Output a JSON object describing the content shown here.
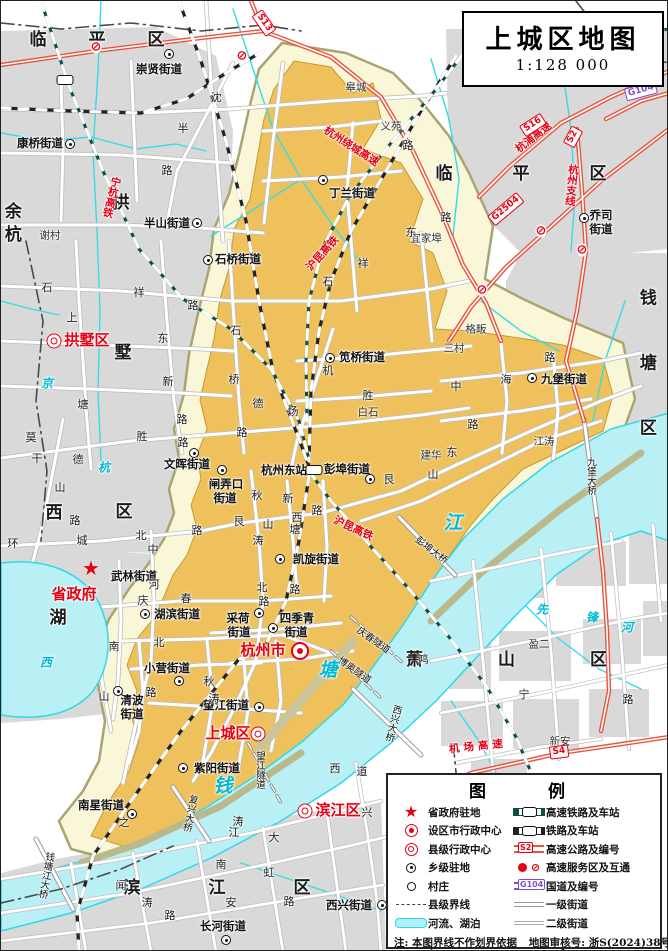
{
  "title": {
    "name": "上城区地图",
    "scale": "1:128 000"
  },
  "legend": {
    "title": "图  例",
    "left": [
      {
        "sym": "star",
        "label": "省政府驻地"
      },
      {
        "sym": "city",
        "label": "设区市行政中心"
      },
      {
        "sym": "county",
        "label": "县级行政中心"
      },
      {
        "sym": "town",
        "label": "乡级驻地"
      },
      {
        "sym": "village",
        "label": "村庄"
      },
      {
        "sym": "boundary",
        "label": "县级界线"
      },
      {
        "sym": "river",
        "label": "河流、湖泊"
      }
    ],
    "right": [
      {
        "sym": "hsr",
        "label": "高速铁路及车站"
      },
      {
        "sym": "rail",
        "label": "铁路及车站"
      },
      {
        "sym": "expwy",
        "label": "高速公路及编号",
        "badge": "S2"
      },
      {
        "sym": "service",
        "label": "高速服务区及互通"
      },
      {
        "sym": "g104",
        "label": "国道及编号",
        "badge": "G104"
      },
      {
        "sym": "road1",
        "label": "一级街道"
      },
      {
        "sym": "road2",
        "label": "二级街道"
      }
    ],
    "note": "注:  本图界线不作划界依据",
    "audit": "地图审核号:  浙S(2024)38号"
  },
  "colors": {
    "district_fill": "#eec15c",
    "district_halo": "#faf6d8",
    "water": "#b9f0f5",
    "urban": "#d9d9d9",
    "expressway": "#e8553d",
    "hsr": "#0e4d44",
    "red_label": "#e60012",
    "g_road": "#7c4fd0"
  },
  "labels": [
    {
      "t": "临平区",
      "x": 117,
      "y": 40,
      "cl": "dist",
      "ls": 42
    },
    {
      "t": "临平区",
      "x": 550,
      "y": 174,
      "cl": "dist",
      "ls": 60
    },
    {
      "t": "余杭",
      "x": 9,
      "y": 224,
      "cl": "dist",
      "v": 1,
      "ls": 6
    },
    {
      "t": "拱",
      "x": 120,
      "y": 203,
      "cl": "dist"
    },
    {
      "t": "墅",
      "x": 122,
      "y": 353,
      "cl": "dist"
    },
    {
      "t": "西",
      "x": 53,
      "y": 513,
      "cl": "dist"
    },
    {
      "t": "区",
      "x": 123,
      "y": 512,
      "cl": "dist"
    },
    {
      "t": "湖",
      "x": 57,
      "y": 618,
      "cl": "dist"
    },
    {
      "t": "钱塘区",
      "x": 644,
      "y": 385,
      "cl": "dist",
      "v": 1,
      "ls": 48
    },
    {
      "t": "萧山区",
      "x": 543,
      "y": 660,
      "cl": "dist",
      "ls": 75
    },
    {
      "t": "滨江区",
      "x": 250,
      "y": 888,
      "cl": "dist",
      "ls": 68
    },
    {
      "t": "省政府",
      "x": 73,
      "y": 594,
      "cl": "redbig",
      "n": "provincial-government"
    },
    {
      "t": "拱墅区",
      "x": 86,
      "y": 340,
      "cl": "redbig",
      "n": "gongshu-district"
    },
    {
      "t": "杭州市",
      "x": 262,
      "y": 650,
      "cl": "redbig",
      "n": "hangzhou-city"
    },
    {
      "t": "上城区",
      "x": 227,
      "y": 733,
      "cl": "redbig",
      "n": "shangcheng-district"
    },
    {
      "t": "滨江区",
      "x": 337,
      "y": 810,
      "cl": "redbig",
      "n": "binjiang-district"
    },
    {
      "t": "崇贤街道",
      "x": 158,
      "y": 68,
      "cl": "sub"
    },
    {
      "t": "康桥街道",
      "x": 39,
      "y": 142,
      "cl": "sub"
    },
    {
      "t": "半山街道",
      "x": 166,
      "y": 222,
      "cl": "sub"
    },
    {
      "t": "石桥街道",
      "x": 237,
      "y": 258,
      "cl": "sub"
    },
    {
      "t": "丁兰街道",
      "x": 351,
      "y": 192,
      "cl": "sub"
    },
    {
      "t": "乔司",
      "x": 600,
      "y": 214,
      "cl": "sub"
    },
    {
      "t": "街道",
      "x": 600,
      "y": 228,
      "cl": "sub"
    },
    {
      "t": "笕桥街道",
      "x": 361,
      "y": 356,
      "cl": "sub"
    },
    {
      "t": "文晖街道",
      "x": 186,
      "y": 463,
      "cl": "sub"
    },
    {
      "t": "闸弄口",
      "x": 225,
      "y": 483,
      "cl": "sub"
    },
    {
      "t": "街道",
      "x": 224,
      "y": 497,
      "cl": "sub"
    },
    {
      "t": "杭州东站",
      "x": 283,
      "y": 469,
      "cl": "sub",
      "n": "hangzhou-east-station"
    },
    {
      "t": "彭埠街道",
      "x": 346,
      "y": 468,
      "cl": "sub"
    },
    {
      "t": "九堡街道",
      "x": 563,
      "y": 378,
      "cl": "sub"
    },
    {
      "t": "凯旋街道",
      "x": 315,
      "y": 558,
      "cl": "sub"
    },
    {
      "t": "采荷",
      "x": 237,
      "y": 617,
      "cl": "sub"
    },
    {
      "t": "街道",
      "x": 238,
      "y": 631,
      "cl": "sub"
    },
    {
      "t": "四季青",
      "x": 296,
      "y": 617,
      "cl": "sub"
    },
    {
      "t": "街道",
      "x": 295,
      "y": 631,
      "cl": "sub"
    },
    {
      "t": "湖滨街道",
      "x": 176,
      "y": 613,
      "cl": "sub"
    },
    {
      "t": "武林街道",
      "x": 133,
      "y": 575,
      "cl": "sub"
    },
    {
      "t": "小营街道",
      "x": 166,
      "y": 667,
      "cl": "sub"
    },
    {
      "t": "清波",
      "x": 131,
      "y": 699,
      "cl": "sub"
    },
    {
      "t": "街道",
      "x": 131,
      "y": 713,
      "cl": "sub"
    },
    {
      "t": "望江街道",
      "x": 225,
      "y": 704,
      "cl": "sub"
    },
    {
      "t": "紫阳街道",
      "x": 216,
      "y": 767,
      "cl": "sub"
    },
    {
      "t": "南星街道",
      "x": 100,
      "y": 804,
      "cl": "sub"
    },
    {
      "t": "西兴街道",
      "x": 348,
      "y": 904,
      "cl": "sub"
    },
    {
      "t": "长河街道",
      "x": 222,
      "y": 925,
      "cl": "sub"
    },
    {
      "t": "谢村",
      "x": 49,
      "y": 235,
      "cl": "vil"
    },
    {
      "t": "皋城",
      "x": 355,
      "y": 87,
      "cl": "vil"
    },
    {
      "t": "义苑",
      "x": 390,
      "y": 126,
      "cl": "vil"
    },
    {
      "t": "宜家埠",
      "x": 425,
      "y": 238,
      "cl": "vil"
    },
    {
      "t": "格畈",
      "x": 475,
      "y": 329,
      "cl": "vil"
    },
    {
      "t": "三村",
      "x": 453,
      "y": 348,
      "cl": "vil"
    },
    {
      "t": "白石",
      "x": 367,
      "y": 412,
      "cl": "vil"
    },
    {
      "t": "建华",
      "x": 430,
      "y": 455,
      "cl": "vil"
    },
    {
      "t": "江涛",
      "x": 543,
      "y": 441,
      "cl": "vil"
    },
    {
      "t": "盈二",
      "x": 538,
      "y": 644,
      "cl": "vil"
    },
    {
      "t": "新安",
      "x": 559,
      "y": 741,
      "cl": "vil"
    },
    {
      "t": "沈",
      "x": 215,
      "y": 97,
      "cl": "road"
    },
    {
      "t": "半",
      "x": 182,
      "y": 128,
      "cl": "road"
    },
    {
      "t": "路",
      "x": 166,
      "y": 170,
      "cl": "road"
    },
    {
      "t": "石",
      "x": 46,
      "y": 287,
      "cl": "road"
    },
    {
      "t": "祥",
      "x": 138,
      "y": 292,
      "cl": "road"
    },
    {
      "t": "路",
      "x": 192,
      "y": 305,
      "cl": "road"
    },
    {
      "t": "石",
      "x": 327,
      "y": 281,
      "cl": "road"
    },
    {
      "t": "祥",
      "x": 362,
      "y": 263,
      "cl": "road"
    },
    {
      "t": "上",
      "x": 71,
      "y": 317,
      "cl": "road"
    },
    {
      "t": "塘",
      "x": 82,
      "y": 404,
      "cl": "road"
    },
    {
      "t": "东",
      "x": 162,
      "y": 338,
      "cl": "road"
    },
    {
      "t": "新",
      "x": 167,
      "y": 381,
      "cl": "road"
    },
    {
      "t": "路",
      "x": 181,
      "y": 419,
      "cl": "road"
    },
    {
      "t": "莫",
      "x": 30,
      "y": 437,
      "cl": "road"
    },
    {
      "t": "干",
      "x": 36,
      "y": 458,
      "cl": "road"
    },
    {
      "t": "山",
      "x": 59,
      "y": 487,
      "cl": "road"
    },
    {
      "t": "路",
      "x": 74,
      "y": 520,
      "cl": "road"
    },
    {
      "t": "德",
      "x": 77,
      "y": 459,
      "cl": "road"
    },
    {
      "t": "胜",
      "x": 141,
      "y": 436,
      "cl": "road"
    },
    {
      "t": "路",
      "x": 182,
      "y": 442,
      "cl": "road"
    },
    {
      "t": "德",
      "x": 257,
      "y": 403,
      "cl": "road"
    },
    {
      "t": "胜",
      "x": 367,
      "y": 395,
      "cl": "road"
    },
    {
      "t": "石",
      "x": 235,
      "y": 330,
      "cl": "road"
    },
    {
      "t": "桥",
      "x": 233,
      "y": 379,
      "cl": "road"
    },
    {
      "t": "路",
      "x": 241,
      "y": 432,
      "cl": "road"
    },
    {
      "t": "机",
      "x": 327,
      "y": 370,
      "cl": "road"
    },
    {
      "t": "场",
      "x": 292,
      "y": 411,
      "cl": "road"
    },
    {
      "t": "环",
      "x": 12,
      "y": 543,
      "cl": "road"
    },
    {
      "t": "城",
      "x": 81,
      "y": 540,
      "cl": "road"
    },
    {
      "t": "北",
      "x": 140,
      "y": 535,
      "cl": "road"
    },
    {
      "t": "路",
      "x": 196,
      "y": 530,
      "cl": "road"
    },
    {
      "t": "中",
      "x": 152,
      "y": 549,
      "cl": "road"
    },
    {
      "t": "河",
      "x": 153,
      "y": 584,
      "cl": "road"
    },
    {
      "t": "庆",
      "x": 142,
      "y": 600,
      "cl": "road"
    },
    {
      "t": "春",
      "x": 185,
      "y": 598,
      "cl": "road"
    },
    {
      "t": "路",
      "x": 263,
      "y": 601,
      "cl": "road"
    },
    {
      "t": "秋",
      "x": 256,
      "y": 495,
      "cl": "road"
    },
    {
      "t": "涛",
      "x": 257,
      "y": 540,
      "cl": "road"
    },
    {
      "t": "新",
      "x": 287,
      "y": 498,
      "cl": "road"
    },
    {
      "t": "塘",
      "x": 294,
      "y": 529,
      "cl": "road"
    },
    {
      "t": "艮",
      "x": 238,
      "y": 521,
      "cl": "road"
    },
    {
      "t": "山",
      "x": 267,
      "y": 524,
      "cl": "road"
    },
    {
      "t": "西",
      "x": 296,
      "y": 517,
      "cl": "road"
    },
    {
      "t": "路",
      "x": 316,
      "y": 510,
      "cl": "road"
    },
    {
      "t": "艮",
      "x": 388,
      "y": 479,
      "cl": "road"
    },
    {
      "t": "山",
      "x": 432,
      "y": 474,
      "cl": "road"
    },
    {
      "t": "东",
      "x": 451,
      "y": 452,
      "cl": "road"
    },
    {
      "t": "路",
      "x": 472,
      "y": 424,
      "cl": "road"
    },
    {
      "t": "北",
      "x": 261,
      "y": 587,
      "cl": "road"
    },
    {
      "t": "路",
      "x": 294,
      "y": 589,
      "cl": "road"
    },
    {
      "t": "中",
      "x": 455,
      "y": 386,
      "cl": "road"
    },
    {
      "t": "海",
      "x": 505,
      "y": 379,
      "cl": "road"
    },
    {
      "t": "路",
      "x": 549,
      "y": 357,
      "cl": "road"
    },
    {
      "t": "东",
      "x": 410,
      "y": 232,
      "cl": "road"
    },
    {
      "t": "路",
      "x": 445,
      "y": 217,
      "cl": "road"
    },
    {
      "t": "路",
      "x": 407,
      "y": 145,
      "cl": "road"
    },
    {
      "t": "秋",
      "x": 208,
      "y": 681,
      "cl": "road"
    },
    {
      "t": "涛",
      "x": 213,
      "y": 698,
      "cl": "road"
    },
    {
      "t": "南",
      "x": 113,
      "y": 646,
      "cl": "road"
    },
    {
      "t": "北",
      "x": 158,
      "y": 642,
      "cl": "road"
    },
    {
      "t": "山",
      "x": 103,
      "y": 696,
      "cl": "road"
    },
    {
      "t": "路",
      "x": 150,
      "y": 692,
      "cl": "road"
    },
    {
      "t": "之",
      "x": 123,
      "y": 822,
      "cl": "road"
    },
    {
      "t": "宁",
      "x": 523,
      "y": 694,
      "cl": "road"
    },
    {
      "t": "路",
      "x": 627,
      "y": 699,
      "cl": "road"
    },
    {
      "t": "鸿",
      "x": 422,
      "y": 659,
      "cl": "road"
    },
    {
      "t": "闻",
      "x": 120,
      "y": 885,
      "cl": "road"
    },
    {
      "t": "涛",
      "x": 146,
      "y": 902,
      "cl": "road"
    },
    {
      "t": "路",
      "x": 169,
      "y": 915,
      "cl": "road"
    },
    {
      "t": "南",
      "x": 220,
      "y": 864,
      "cl": "road"
    },
    {
      "t": "江",
      "x": 233,
      "y": 832,
      "cl": "road"
    },
    {
      "t": "大",
      "x": 273,
      "y": 837,
      "cl": "road"
    },
    {
      "t": "虹",
      "x": 268,
      "y": 872,
      "cl": "road"
    },
    {
      "t": "路",
      "x": 288,
      "y": 901,
      "cl": "road"
    },
    {
      "t": "安",
      "x": 230,
      "y": 902,
      "cl": "road"
    },
    {
      "t": "涛",
      "x": 237,
      "y": 821,
      "cl": "road"
    },
    {
      "t": "兴",
      "x": 366,
      "y": 812,
      "cl": "road"
    },
    {
      "t": "西",
      "x": 334,
      "y": 768,
      "cl": "road"
    },
    {
      "t": "道",
      "x": 361,
      "y": 771,
      "cl": "road"
    },
    {
      "t": "彭埠大桥",
      "x": 430,
      "y": 550,
      "cl": "brg",
      "r": 38
    },
    {
      "t": "九堡大桥",
      "x": 589,
      "y": 475,
      "cl": "brg",
      "v": 1
    },
    {
      "t": "西兴大桥",
      "x": 391,
      "y": 722,
      "cl": "brg",
      "v": 1,
      "r": 15
    },
    {
      "t": "复兴大桥",
      "x": 188,
      "y": 812,
      "cl": "brg",
      "v": 1,
      "r": 12
    },
    {
      "t": "钱塘江大桥",
      "x": 44,
      "y": 874,
      "cl": "brg",
      "v": 1,
      "r": 10
    },
    {
      "t": "望江隧道",
      "x": 258,
      "y": 769,
      "cl": "brg",
      "v": 1
    },
    {
      "t": "庆春隧道",
      "x": 372,
      "y": 640,
      "cl": "brg",
      "r": 35
    },
    {
      "t": "博奥隧道",
      "x": 353,
      "y": 670,
      "cl": "brg",
      "r": 35
    },
    {
      "t": "钱",
      "x": 222,
      "y": 786,
      "cl": "waterlb waterbig"
    },
    {
      "t": "塘",
      "x": 327,
      "y": 670,
      "cl": "waterlb waterbig"
    },
    {
      "t": "江",
      "x": 452,
      "y": 523,
      "cl": "waterlb waterbig"
    },
    {
      "t": "京",
      "x": 46,
      "y": 383,
      "cl": "waterlb"
    },
    {
      "t": "杭",
      "x": 103,
      "y": 467,
      "cl": "waterlb"
    },
    {
      "t": "西",
      "x": 45,
      "y": 662,
      "cl": "waterlb"
    },
    {
      "t": "先",
      "x": 541,
      "y": 609,
      "cl": "waterlb"
    },
    {
      "t": "锋",
      "x": 591,
      "y": 617,
      "cl": "waterlb"
    },
    {
      "t": "河",
      "x": 626,
      "y": 627,
      "cl": "waterlb"
    },
    {
      "t": "宁杭高铁",
      "x": 110,
      "y": 196,
      "cl": "railred",
      "v": 1,
      "r": 14
    },
    {
      "t": "沪昆高铁",
      "x": 322,
      "y": 253,
      "cl": "railred",
      "r": -48
    },
    {
      "t": "沪昆高铁",
      "x": 352,
      "y": 528,
      "cl": "railred",
      "r": 25
    },
    {
      "t": "杭州绕城高速",
      "x": 350,
      "y": 146,
      "cl": "railred",
      "r": 33
    },
    {
      "t": "杭浦高速",
      "x": 533,
      "y": 137,
      "cl": "railred",
      "r": -38
    },
    {
      "t": "杭州支线",
      "x": 570,
      "y": 184,
      "cl": "railred",
      "v": 1,
      "r": 6
    },
    {
      "t": "机场高速",
      "x": 477,
      "y": 746,
      "cl": "railred",
      "r": -6,
      "ls": 4
    }
  ],
  "markers": [
    {
      "k": "star",
      "x": 90,
      "y": 567,
      "n": "provincial-government-star"
    },
    {
      "k": "city",
      "x": 299,
      "y": 650,
      "n": "city-center-marker"
    },
    {
      "k": "county",
      "x": 53,
      "y": 340
    },
    {
      "k": "county",
      "x": 257,
      "y": 733
    },
    {
      "k": "county",
      "x": 304,
      "y": 810
    },
    {
      "k": "town",
      "x": 168,
      "y": 53
    },
    {
      "k": "town",
      "x": 69,
      "y": 143
    },
    {
      "k": "town",
      "x": 196,
      "y": 222
    },
    {
      "k": "town",
      "x": 207,
      "y": 259
    },
    {
      "k": "town",
      "x": 322,
      "y": 179
    },
    {
      "k": "town",
      "x": 583,
      "y": 217
    },
    {
      "k": "town",
      "x": 329,
      "y": 357
    },
    {
      "k": "town",
      "x": 193,
      "y": 452
    },
    {
      "k": "town",
      "x": 221,
      "y": 469
    },
    {
      "k": "town",
      "x": 369,
      "y": 478
    },
    {
      "k": "town",
      "x": 531,
      "y": 377
    },
    {
      "k": "town",
      "x": 279,
      "y": 558
    },
    {
      "k": "town",
      "x": 258,
      "y": 612
    },
    {
      "k": "town",
      "x": 272,
      "y": 627
    },
    {
      "k": "town",
      "x": 144,
      "y": 613
    },
    {
      "k": "town",
      "x": 178,
      "y": 680
    },
    {
      "k": "town",
      "x": 117,
      "y": 690
    },
    {
      "k": "town",
      "x": 258,
      "y": 706
    },
    {
      "k": "town",
      "x": 182,
      "y": 767
    },
    {
      "k": "town",
      "x": 131,
      "y": 813
    },
    {
      "k": "town",
      "x": 381,
      "y": 904
    },
    {
      "k": "town",
      "x": 225,
      "y": 939
    },
    {
      "k": "village",
      "x": 36,
      "y": 226
    },
    {
      "k": "village",
      "x": 371,
      "y": 85
    },
    {
      "k": "village",
      "x": 387,
      "y": 135
    },
    {
      "k": "village",
      "x": 449,
      "y": 238
    },
    {
      "k": "village",
      "x": 480,
      "y": 317
    },
    {
      "k": "village",
      "x": 438,
      "y": 348
    },
    {
      "k": "village",
      "x": 350,
      "y": 412
    },
    {
      "k": "village",
      "x": 413,
      "y": 456
    },
    {
      "k": "village",
      "x": 543,
      "y": 430
    },
    {
      "k": "village",
      "x": 518,
      "y": 645
    },
    {
      "k": "village",
      "x": 545,
      "y": 742
    },
    {
      "k": "station",
      "x": 313,
      "y": 469
    },
    {
      "k": "station",
      "x": 64,
      "y": 79
    },
    {
      "k": "int",
      "x": 95,
      "y": 46
    },
    {
      "k": "int",
      "x": 241,
      "y": 55
    },
    {
      "k": "int",
      "x": 540,
      "y": 230
    },
    {
      "k": "int",
      "x": 581,
      "y": 249
    },
    {
      "k": "int",
      "x": 481,
      "y": 289
    }
  ],
  "badges": [
    {
      "t": "S13",
      "x": 263,
      "y": 22,
      "r": 55
    },
    {
      "t": "S16",
      "x": 532,
      "y": 124,
      "r": -33
    },
    {
      "t": "S2",
      "x": 572,
      "y": 136,
      "r": -62
    },
    {
      "t": "G2504",
      "x": 505,
      "y": 208,
      "r": -40
    },
    {
      "t": "G104",
      "x": 640,
      "y": 90,
      "r": -15,
      "kind": "g"
    },
    {
      "t": "S4",
      "x": 558,
      "y": 751,
      "r": -7
    }
  ]
}
